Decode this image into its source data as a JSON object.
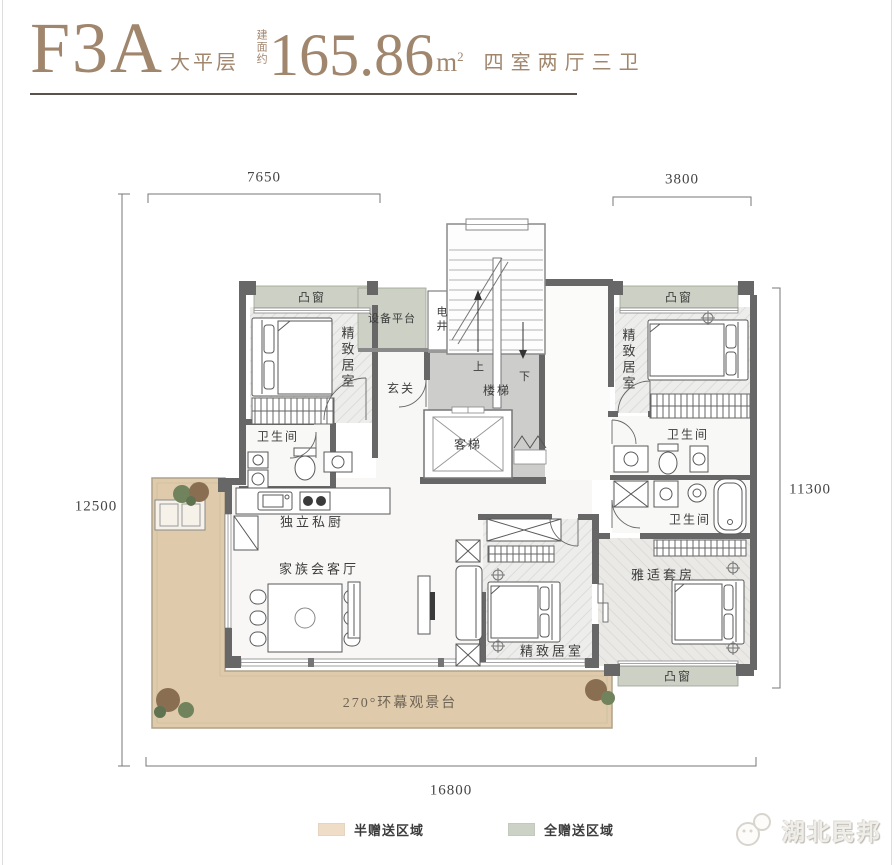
{
  "header": {
    "unit_code": "F3A",
    "unit_type": "大平层",
    "area_label": "建面约",
    "area_value": "165.86",
    "area_unit": "m",
    "area_sup": "2",
    "room_config": "四室两厅三卫"
  },
  "dimensions": {
    "top_left": "7650",
    "top_right": "3800",
    "left": "12500",
    "right": "11300",
    "bottom": "16800"
  },
  "rooms": {
    "bay_window": "凸窗",
    "equipment_platform": "设备平台",
    "electrical_shaft": "电井",
    "foyer": "玄关",
    "stairs": "楼梯",
    "stairs_up": "上",
    "stairs_down": "下",
    "elevator": "客梯",
    "bedroom": "精致居室",
    "bathroom": "卫生间",
    "kitchen": "独立私厨",
    "living_room": "家族会客厅",
    "suite": "雅适套房",
    "terrace": "270°环幕观景台"
  },
  "legend": {
    "items": [
      {
        "label": "半赠送区域",
        "color": "#f0ddc8"
      },
      {
        "label": "全赠送区域",
        "color": "#ccd2c6"
      }
    ]
  },
  "watermark": {
    "brand": "湖北民邦"
  },
  "colors": {
    "accent_brown": "#a1866e",
    "semi_gift_area": "#dfcbab",
    "full_gift_area": "#cdd1c5",
    "wall": "#676767",
    "core_floor": "#cdcdcb"
  }
}
